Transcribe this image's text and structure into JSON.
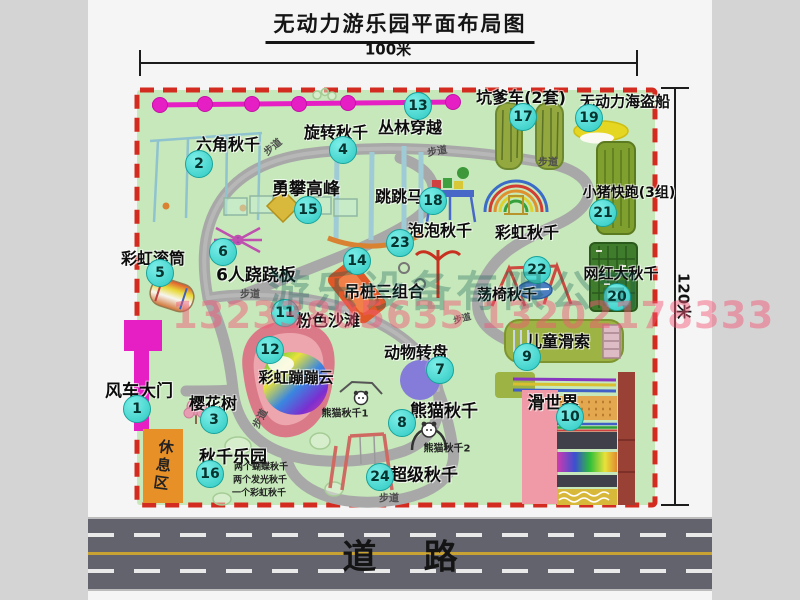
{
  "title": "无动力游乐园平面布局图",
  "dimensions": {
    "top": "100米",
    "right": "120米"
  },
  "road": {
    "label": "道    路"
  },
  "watermark": {
    "company": "游乐设备有限公司",
    "phone": "13233805635 13202178333"
  },
  "rest_area": {
    "label": "休息区"
  },
  "markers": [
    {
      "num": "1",
      "label": "风车大门",
      "bx": 137,
      "by": 409,
      "lx": 139,
      "ly": 389,
      "fs": 17
    },
    {
      "num": "2",
      "label": "六角秋千",
      "bx": 199,
      "by": 164,
      "lx": 228,
      "ly": 143,
      "fs": 16
    },
    {
      "num": "3",
      "label": "樱花树",
      "bx": 214,
      "by": 420,
      "lx": 213,
      "ly": 402,
      "fs": 16
    },
    {
      "num": "4",
      "label": "旋转秋千",
      "bx": 343,
      "by": 150,
      "lx": 336,
      "ly": 131,
      "fs": 16
    },
    {
      "num": "5",
      "label": "彩虹滚筒",
      "bx": 160,
      "by": 273,
      "lx": 153,
      "ly": 257,
      "fs": 16
    },
    {
      "num": "6",
      "label": "6人跷跷板",
      "bx": 223,
      "by": 252,
      "lx": 256,
      "ly": 273,
      "fs": 17
    },
    {
      "num": "7",
      "label": "动物转盘",
      "bx": 440,
      "by": 370,
      "lx": 416,
      "ly": 351,
      "fs": 16
    },
    {
      "num": "8",
      "label": "熊猫秋千",
      "bx": 402,
      "by": 423,
      "lx": 444,
      "ly": 409,
      "fs": 17
    },
    {
      "num": "9",
      "label": "儿童滑索",
      "bx": 527,
      "by": 357,
      "lx": 558,
      "ly": 340,
      "fs": 16
    },
    {
      "num": "10",
      "label": "滑世界",
      "bx": 570,
      "by": 417,
      "lx": 553,
      "ly": 401,
      "fs": 17
    },
    {
      "num": "11",
      "label": "粉色沙滩",
      "bx": 285,
      "by": 313,
      "lx": 328,
      "ly": 319,
      "fs": 16
    },
    {
      "num": "12",
      "label": "彩虹蹦蹦云",
      "bx": 270,
      "by": 350,
      "lx": 296,
      "ly": 377,
      "fs": 15
    },
    {
      "num": "13",
      "label": "丛林穿越",
      "bx": 418,
      "by": 106,
      "lx": 410,
      "ly": 126,
      "fs": 16
    },
    {
      "num": "14",
      "label": "吊桩三组合",
      "bx": 357,
      "by": 261,
      "lx": 384,
      "ly": 290,
      "fs": 16
    },
    {
      "num": "15",
      "label": "勇攀高峰",
      "bx": 308,
      "by": 210,
      "lx": 306,
      "ly": 187,
      "fs": 17
    },
    {
      "num": "16",
      "label": "秋千乐园",
      "bx": 210,
      "by": 474,
      "lx": 233,
      "ly": 455,
      "fs": 17
    },
    {
      "num": "17",
      "label": "坑爹车(2套)",
      "bx": 523,
      "by": 117,
      "lx": 521,
      "ly": 96,
      "fs": 16
    },
    {
      "num": "18",
      "label": "跳跳马",
      "bx": 433,
      "by": 201,
      "lx": 399,
      "ly": 195,
      "fs": 16
    },
    {
      "num": "19",
      "label": "无动力海盗船",
      "bx": 589,
      "by": 118,
      "lx": 625,
      "ly": 101,
      "fs": 15
    },
    {
      "num": "20",
      "label": "网红大秋千",
      "bx": 617,
      "by": 297,
      "lx": 621,
      "ly": 273,
      "fs": 15
    },
    {
      "num": "21",
      "label": "小猪快跑(3组)",
      "bx": 603,
      "by": 213,
      "lx": 629,
      "ly": 192,
      "fs": 14
    },
    {
      "num": "22",
      "label": "荡椅秋千",
      "bx": 537,
      "by": 270,
      "lx": 507,
      "ly": 294,
      "fs": 15
    },
    {
      "num": "23",
      "label": "泡泡秋千",
      "bx": 400,
      "by": 243,
      "lx": 440,
      "ly": 229,
      "fs": 16
    },
    {
      "num": "24",
      "label": "超级秋千",
      "bx": 380,
      "by": 477,
      "lx": 424,
      "ly": 473,
      "fs": 17
    }
  ],
  "extra_labels": [
    {
      "text": "彩虹秋千",
      "x": 527,
      "y": 231,
      "fs": 16,
      "cls": "map-label"
    },
    {
      "text": "熊猫秋千1",
      "x": 345,
      "y": 412,
      "fs": 10,
      "cls": "note-label"
    },
    {
      "text": "熊猫秋千2",
      "x": 447,
      "y": 447,
      "fs": 10,
      "cls": "note-label"
    },
    {
      "text": "两个蝴蝶秋千",
      "x": 261,
      "y": 466,
      "fs": 9,
      "cls": "note-label"
    },
    {
      "text": "两个发光秋千",
      "x": 260,
      "y": 479,
      "fs": 9,
      "cls": "note-label"
    },
    {
      "text": "一个彩虹秋千",
      "x": 259,
      "y": 492,
      "fs": 9,
      "cls": "note-label"
    },
    {
      "text": "步道",
      "x": 272,
      "y": 146,
      "fs": 10,
      "rot": -40,
      "cls": "path-label"
    },
    {
      "text": "步道",
      "x": 437,
      "y": 150,
      "fs": 10,
      "rot": -10,
      "cls": "path-label"
    },
    {
      "text": "步道",
      "x": 548,
      "y": 161,
      "fs": 10,
      "cls": "path-label"
    },
    {
      "text": "步道",
      "x": 250,
      "y": 293,
      "fs": 10,
      "cls": "path-label"
    },
    {
      "text": "步道",
      "x": 259,
      "y": 418,
      "fs": 10,
      "rot": -62,
      "cls": "path-label"
    },
    {
      "text": "步道",
      "x": 389,
      "y": 497,
      "fs": 10,
      "cls": "path-label"
    },
    {
      "text": "步道",
      "x": 462,
      "y": 318,
      "fs": 9,
      "rot": -15,
      "cls": "path-label"
    }
  ]
}
